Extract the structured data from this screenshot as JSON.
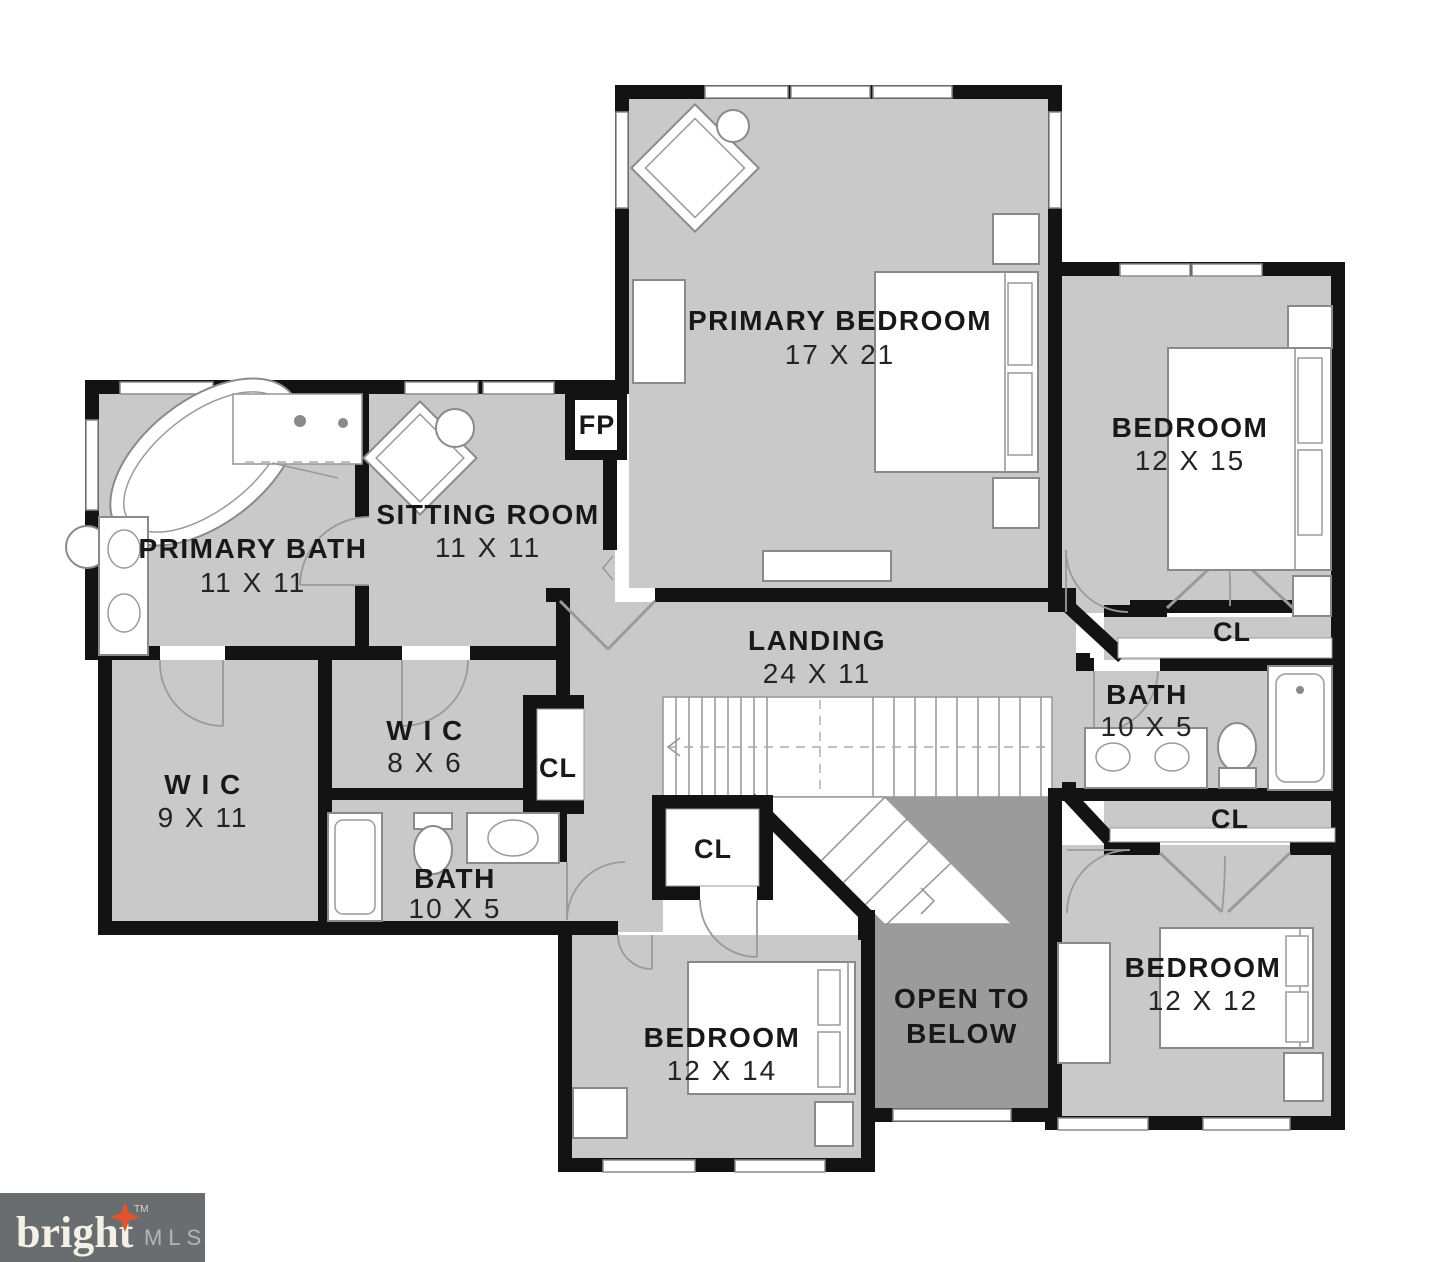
{
  "plan": {
    "colors": {
      "wall": "#131313",
      "room_fill": "#c9c9c9",
      "open_below_fill": "#9b9b9b",
      "paper": "#ffffff"
    },
    "rooms": {
      "primary_bedroom": {
        "name": "PRIMARY BEDROOM",
        "dims": "17 X 21"
      },
      "bedroom_right": {
        "name": "BEDROOM",
        "dims": "12 X 15"
      },
      "primary_bath": {
        "name": "PRIMARY BATH",
        "dims": "11 X 11"
      },
      "sitting_room": {
        "name": "SITTING ROOM",
        "dims": "11 X 11"
      },
      "landing": {
        "name": "LANDING",
        "dims": "24 X 11"
      },
      "wic_large": {
        "name": "W I C",
        "dims": "9 X 11"
      },
      "wic_small": {
        "name": "W I C",
        "dims": "8 X 6"
      },
      "bath_left": {
        "name": "BATH",
        "dims": "10 X 5"
      },
      "bath_right": {
        "name": "BATH",
        "dims": "10 X 5"
      },
      "bedroom_bottom": {
        "name": "BEDROOM",
        "dims": "12 X 14"
      },
      "bedroom_bottom_right": {
        "name": "BEDROOM",
        "dims": "12 X 12"
      },
      "open_to_below": {
        "line1": "OPEN TO",
        "line2": "BELOW"
      }
    },
    "closets": {
      "cl": "CL"
    },
    "fireplace": {
      "label": "FP"
    }
  },
  "logo": {
    "brand": "bright",
    "tm": "TM",
    "suffix": "MLS"
  }
}
